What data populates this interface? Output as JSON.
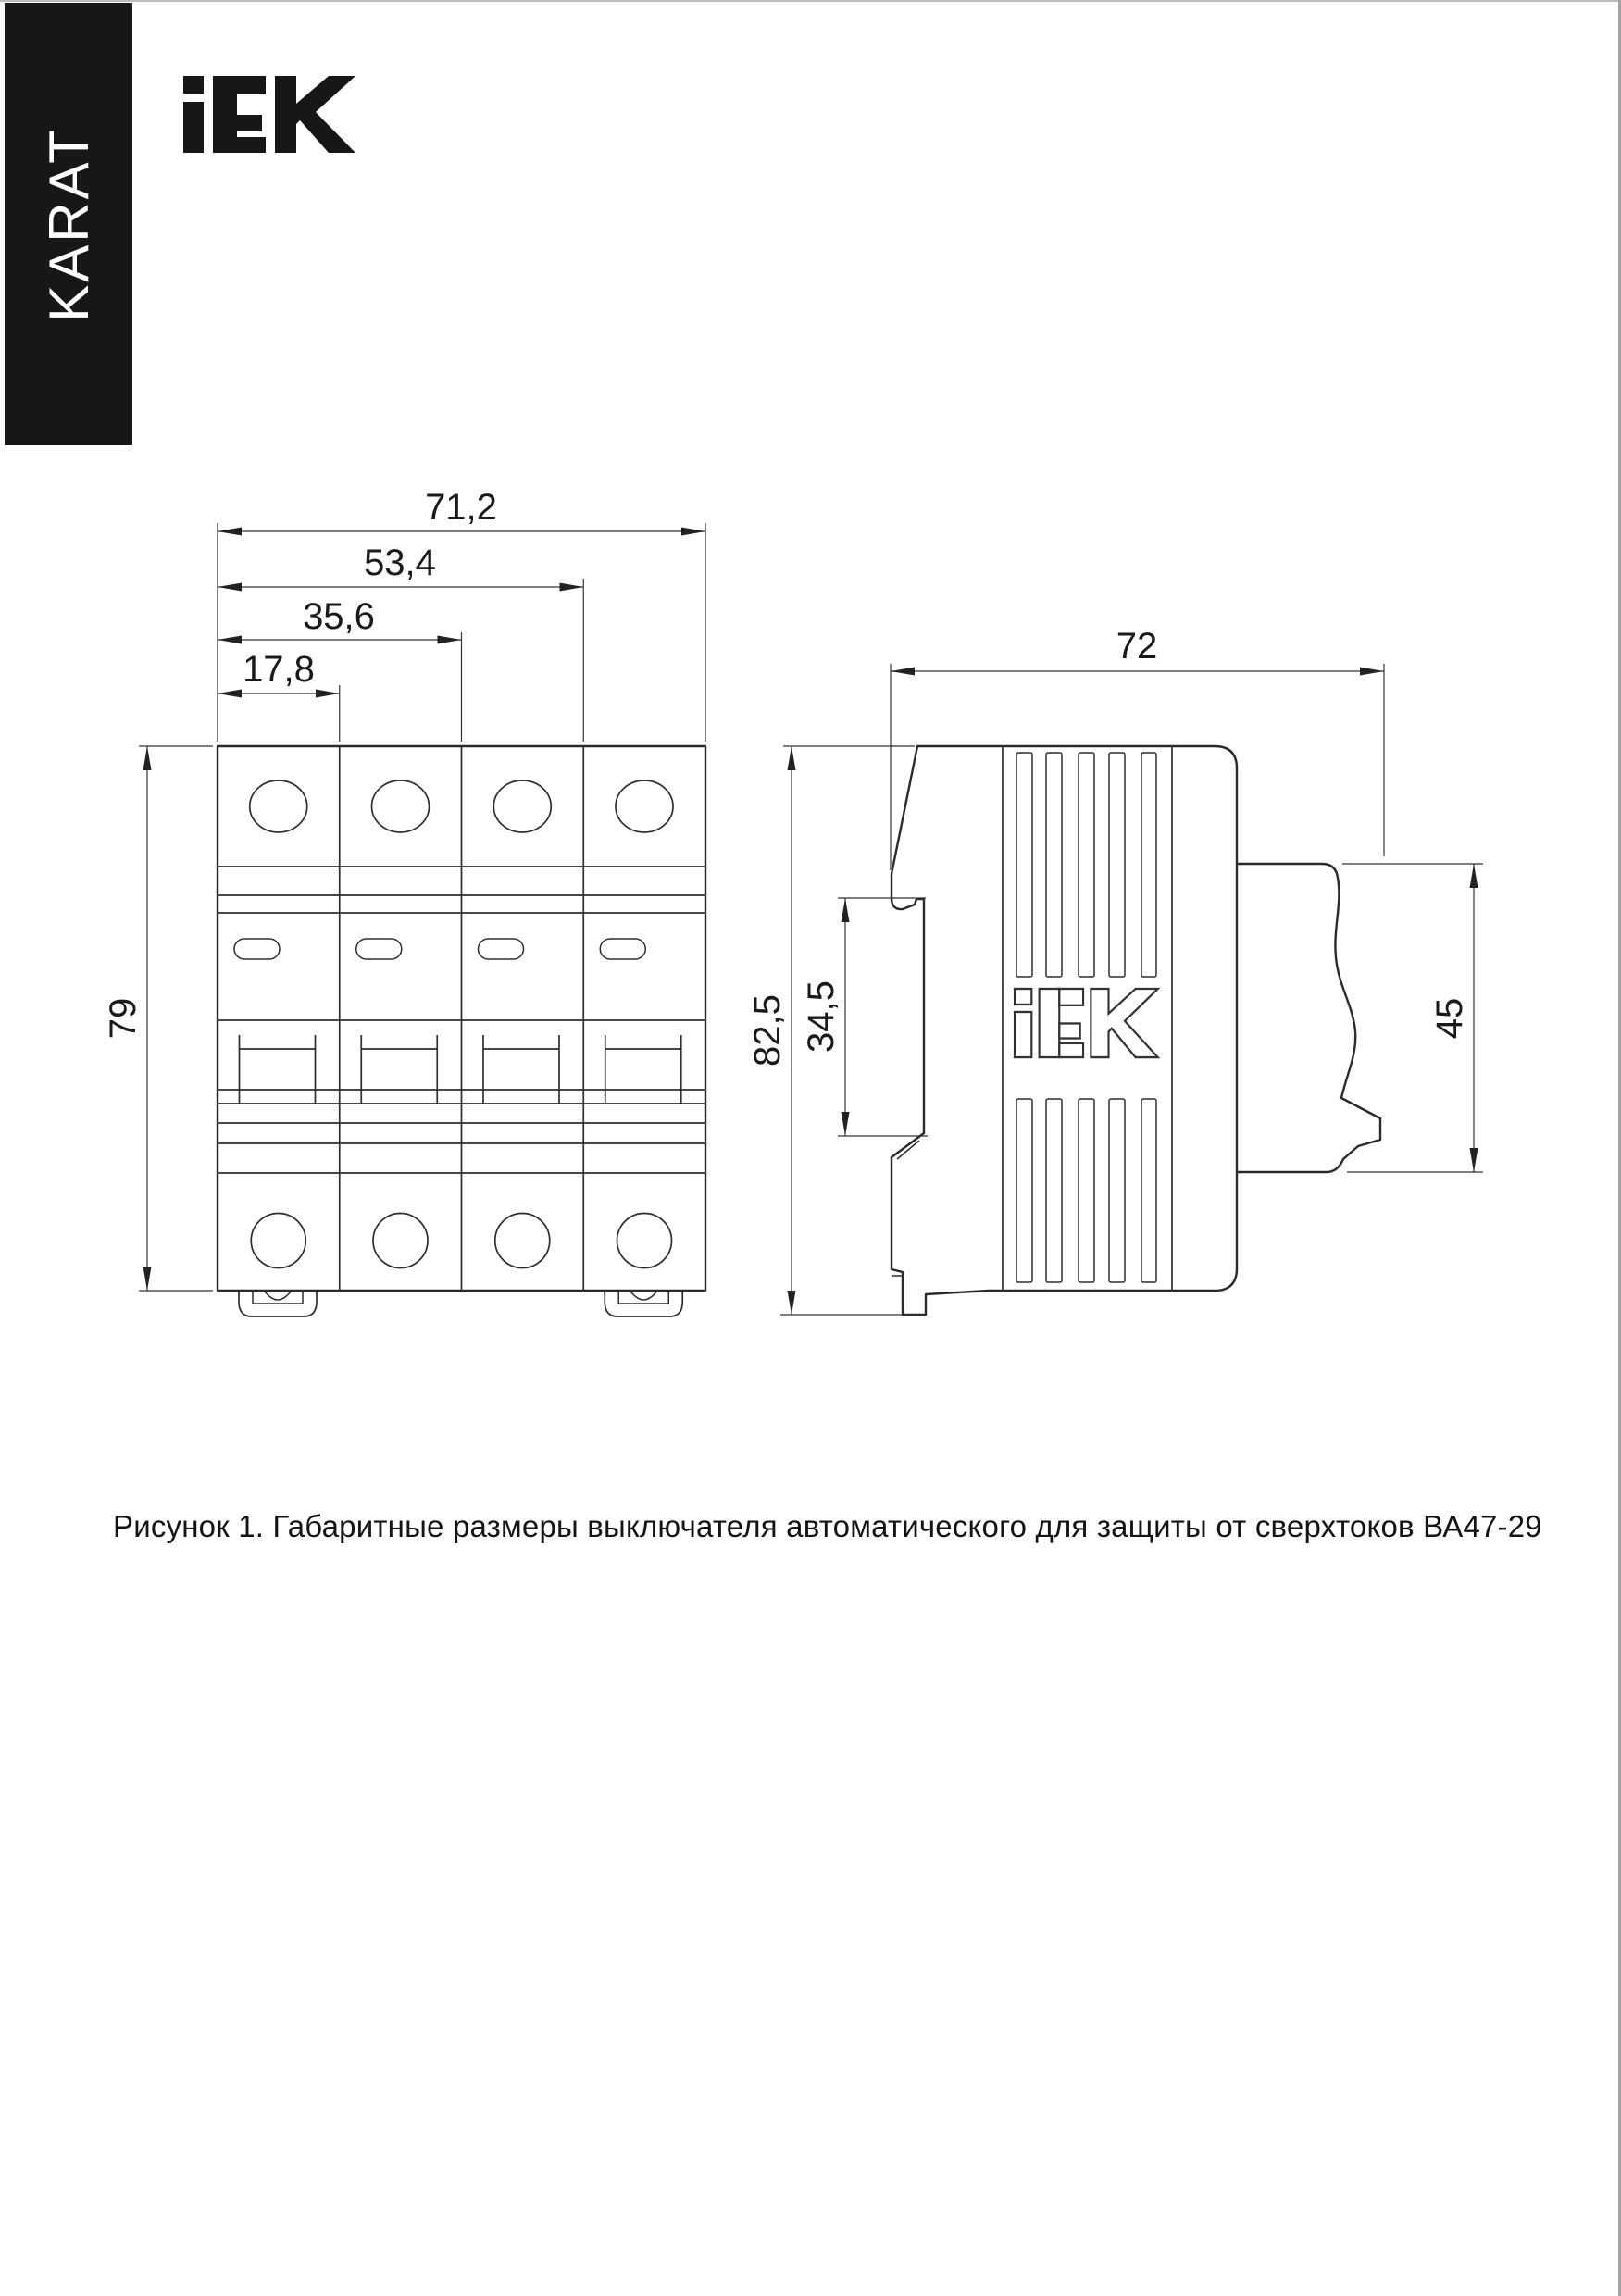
{
  "banner": {
    "text": "KARAT",
    "bg": "#171717",
    "fg": "#ffffff"
  },
  "logo": {
    "text": "iEK",
    "color": "#171717"
  },
  "caption": {
    "text": "Рисунок 1. Габаритные размеры выключателя автоматического для защиты от сверхтоков ВА47-29"
  },
  "drawing": {
    "product": "ВА47-29",
    "units": "mm",
    "front_view": {
      "modules": 4,
      "dims": {
        "width_total": "71,2",
        "width_3_modules": "53,4",
        "width_2_modules": "35,6",
        "width_1_module": "17,8",
        "height": "79"
      }
    },
    "side_view": {
      "dims": {
        "depth": "72",
        "height_total": "82,5",
        "din_groove_height": "34,5",
        "front_face_height": "45"
      }
    },
    "line_color": "#2b2b2b"
  }
}
